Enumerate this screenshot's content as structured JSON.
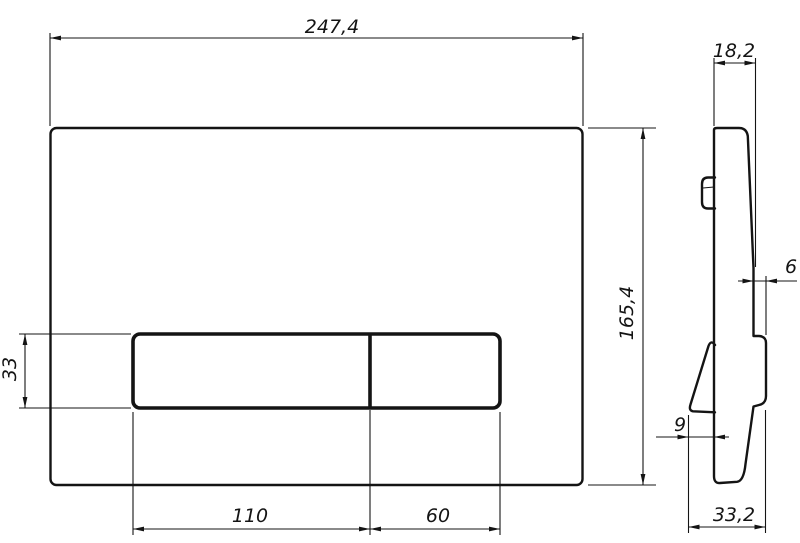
{
  "drawing": {
    "type": "technical-dimension-drawing",
    "subject": "flush-plate",
    "colors": {
      "line": "#141414",
      "background": "#ffffff"
    },
    "front_view": {
      "overall_width": "247,4",
      "overall_height": "165,4",
      "button_cutout_height": "33",
      "large_button_width": "110",
      "small_button_width": "60"
    },
    "side_view": {
      "top_depth": "18,2",
      "button_protrusion": "6",
      "hook_offset": "9",
      "bottom_depth": "33,2"
    }
  }
}
